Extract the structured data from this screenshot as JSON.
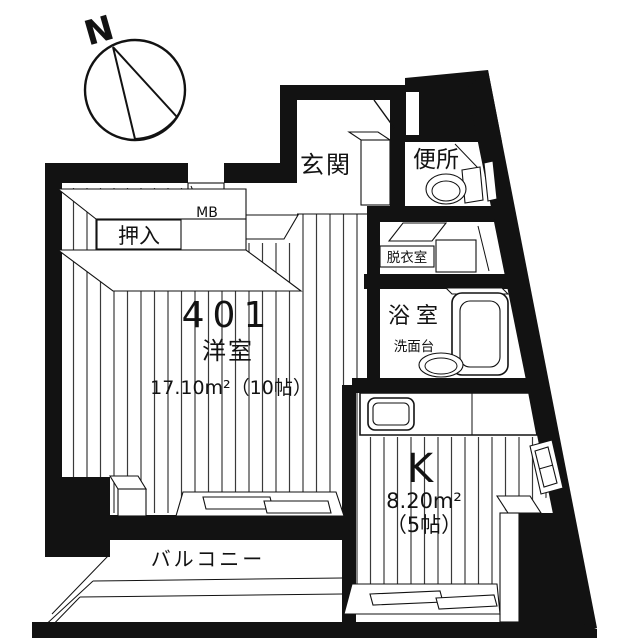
{
  "title": "401号室 間取り図",
  "compass": {
    "north_label": "N"
  },
  "rooms": {
    "entrance": {
      "label": "玄関"
    },
    "toilet": {
      "label": "便所"
    },
    "meter_box": {
      "label": "MB"
    },
    "closet": {
      "label": "押入"
    },
    "dressing_room": {
      "label": "脱衣室"
    },
    "bathroom": {
      "label": "浴室",
      "washstand_label": "洗面台"
    },
    "main_room": {
      "number": "401",
      "type": "洋室",
      "area": "17.10m²（10帖）"
    },
    "kitchen": {
      "label": "K",
      "area": "8.20m²",
      "tatami": "（5帖）"
    },
    "balcony": {
      "label": "バルコニー"
    }
  },
  "colors": {
    "wall": "#121212",
    "background": "#ffffff",
    "floor_line": "#3a3a3a"
  }
}
